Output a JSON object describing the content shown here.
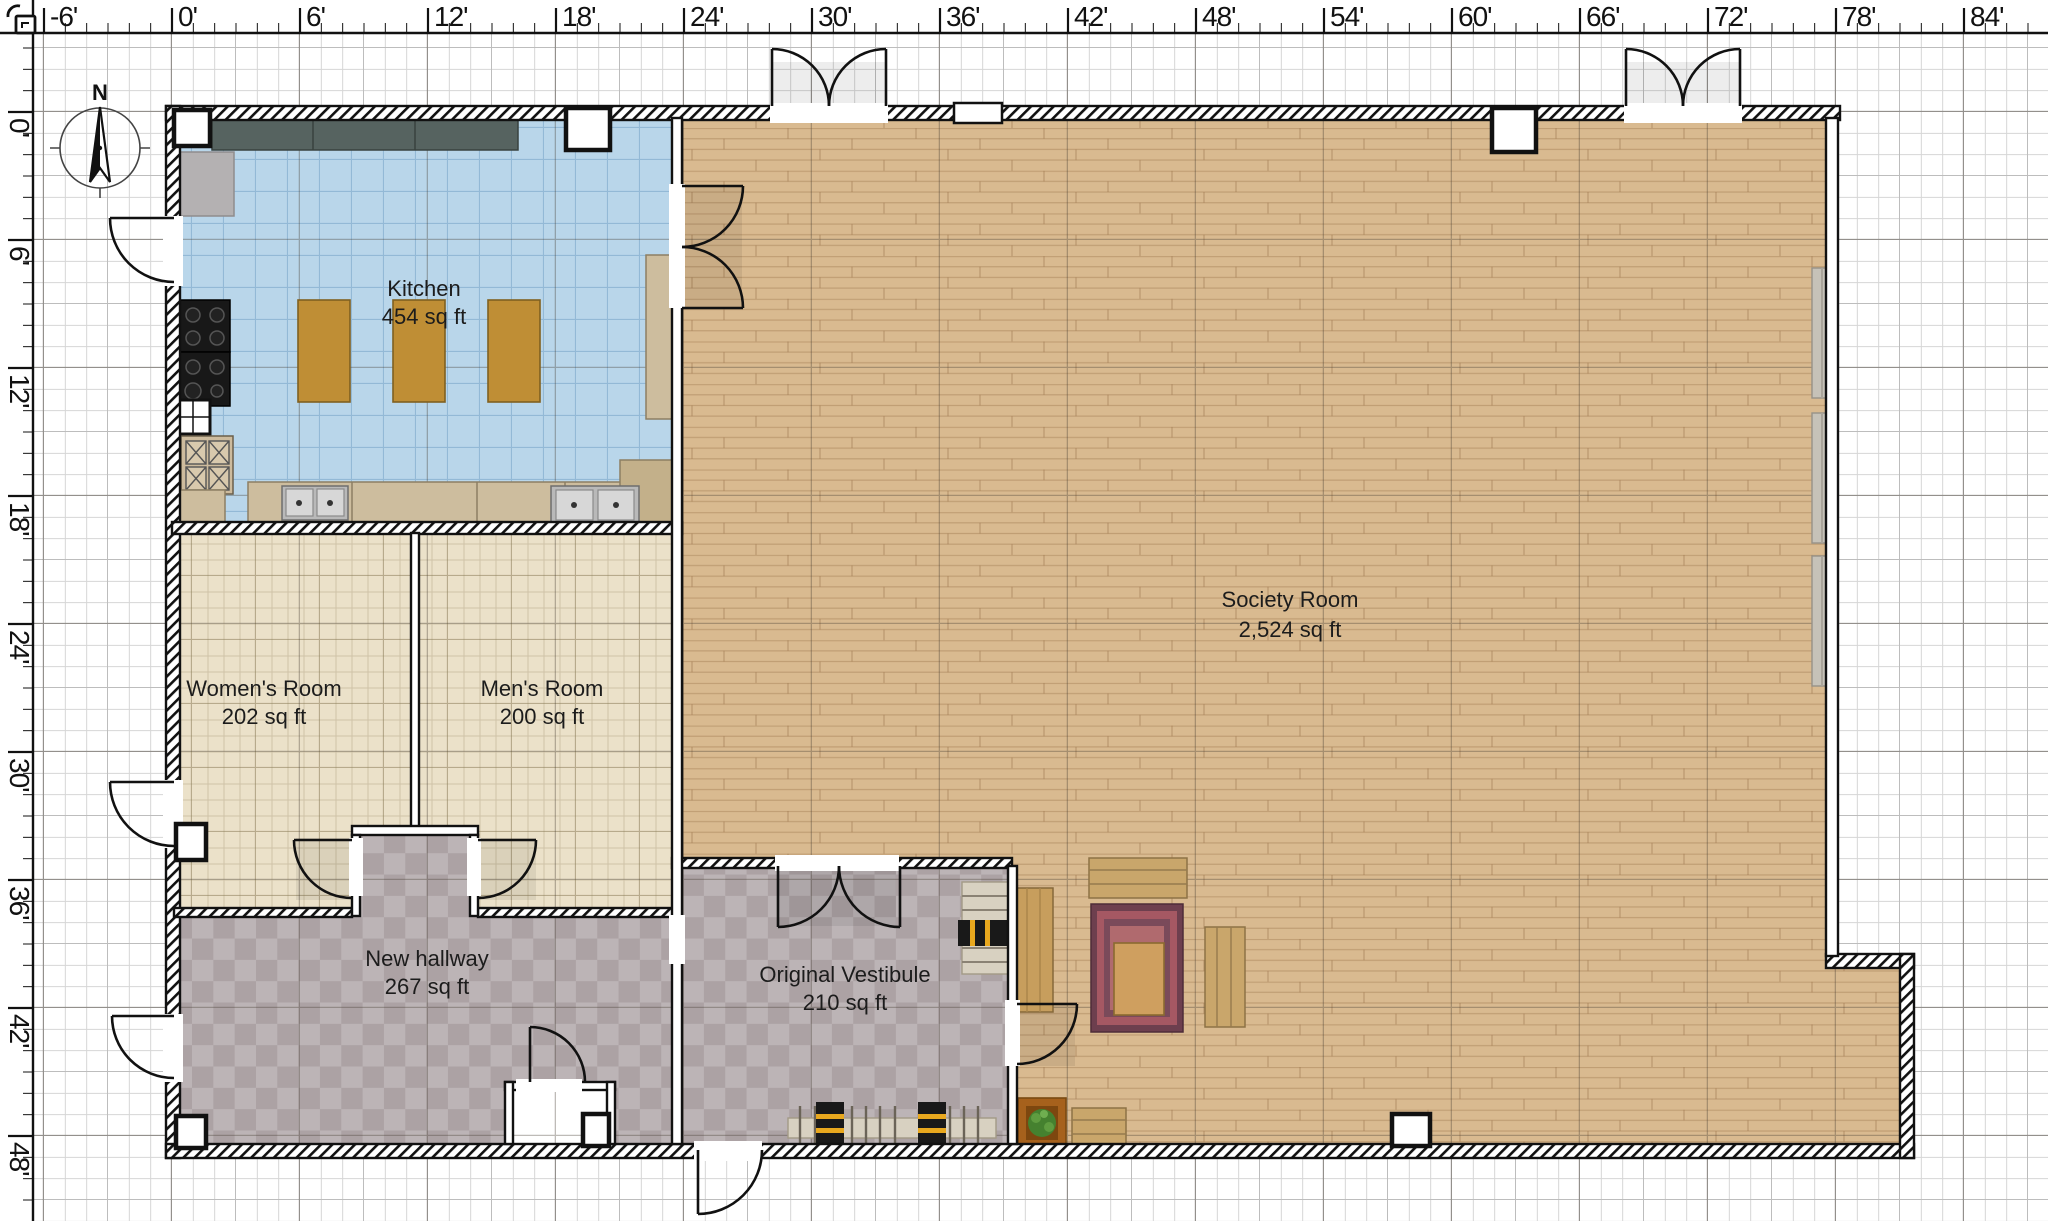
{
  "rulers": {
    "unit": "feet",
    "top_labels": [
      "-6'",
      "0'",
      "6'",
      "12'",
      "18'",
      "24'",
      "30'",
      "36'",
      "42'",
      "48'",
      "54'",
      "60'",
      "66'",
      "72'",
      "78'",
      "84'"
    ],
    "left_labels": [
      "0'",
      "6'",
      "12'",
      "18'",
      "24'",
      "30'",
      "36'",
      "42'",
      "48'"
    ]
  },
  "compass": {
    "label": "N"
  },
  "rooms": [
    {
      "id": "kitchen",
      "name": "Kitchen",
      "area": "454 sq ft"
    },
    {
      "id": "society-room",
      "name": "Society Room",
      "area": "2,524 sq ft"
    },
    {
      "id": "womens-room",
      "name": "Women's Room",
      "area": "202 sq ft"
    },
    {
      "id": "mens-room",
      "name": "Men's Room",
      "area": "200 sq ft"
    },
    {
      "id": "new-hallway",
      "name": "New hallway",
      "area": "267 sq ft"
    },
    {
      "id": "original-vestibule",
      "name": "Original Vestibule",
      "area": "210 sq ft"
    }
  ],
  "palette": {
    "kitchen_floor": "#b9d6ea",
    "restroom_floor": "#ebe1c9",
    "society_floor": "#d9ba90",
    "hallway_checker_dark": "#aca2a4",
    "hallway_checker_light": "#bcb4b6",
    "counter_dark": "#566360",
    "counter_light": "#cdbd9e",
    "island_table": "#bf8e35",
    "wall": "#111111",
    "coat_stripe": "#e8a81e",
    "rug": "#6d3f4e",
    "plant_pot": "#a6611c",
    "plant_foliage": "#45812f"
  }
}
